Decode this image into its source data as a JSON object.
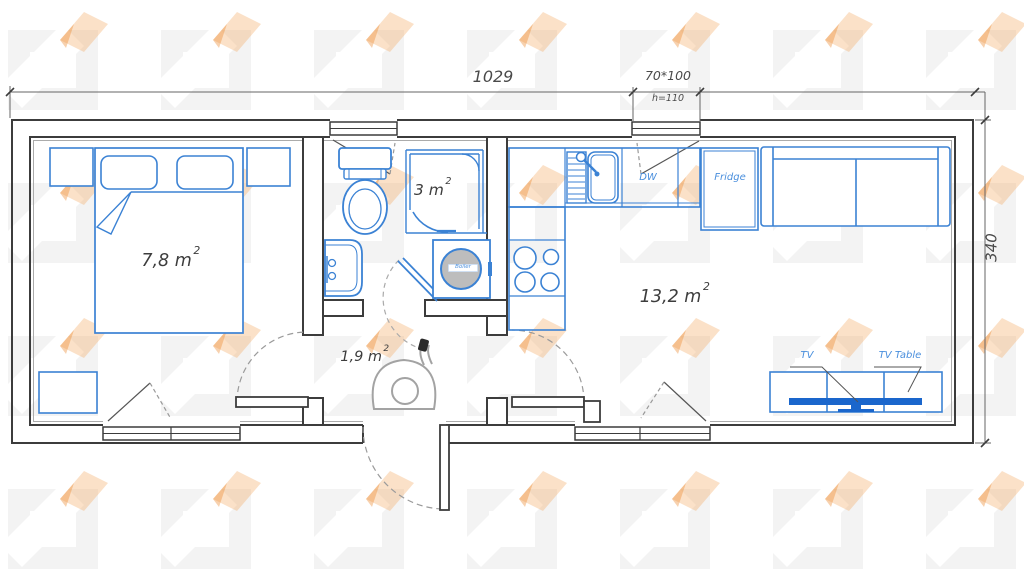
{
  "plan": {
    "dimensions": {
      "total_width": "1029",
      "window_size": "70*100",
      "window_sill": "h=110",
      "total_depth": "340"
    },
    "rooms": {
      "bedroom": {
        "area": "7,8 m",
        "sup": "2"
      },
      "bathroom": {
        "area": "3 m",
        "sup": "2"
      },
      "hallway": {
        "area": "1,9 m",
        "sup": "2"
      },
      "living_kitchen": {
        "area": "13,2 m",
        "sup": "2"
      }
    },
    "appliances": {
      "dishwasher": "DW",
      "fridge": "Fridge",
      "tv": "TV",
      "tv_table": "TV Table",
      "boiler": "Boiler"
    },
    "colors": {
      "furniture_outline": "#3b82d4",
      "tv_fill": "#1a66cc",
      "walls": "#3c3c3c",
      "dimension_lines": "#666666",
      "watermark_orange": "#f2a961",
      "watermark_gray": "#8f8f8f"
    }
  }
}
